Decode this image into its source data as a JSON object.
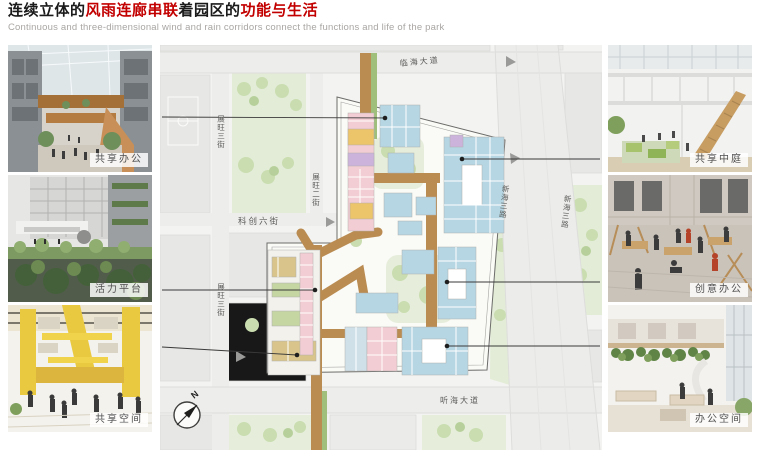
{
  "header": {
    "title_parts": [
      {
        "text": "连续立体的",
        "color": "#1a1a1a"
      },
      {
        "text": "风雨连廊串联",
        "color": "#c30000"
      },
      {
        "text": "着园区的",
        "color": "#1a1a1a"
      },
      {
        "text": "功能与生活",
        "color": "#c30000"
      }
    ],
    "subtitle": "Continuous and three-dimensional wind and rain corridors connect the functions and life of the park"
  },
  "left_photos": [
    {
      "label": "共享办公"
    },
    {
      "label": "活力平台"
    },
    {
      "label": "共享空间"
    }
  ],
  "right_photos": [
    {
      "label": "共享中庭"
    },
    {
      "label": "创意办公"
    },
    {
      "label": "办公空间"
    }
  ],
  "map": {
    "roads": {
      "top": "临海大道",
      "bottom": "听海大道",
      "mid": "科创六街",
      "left_outer": "展旺三街",
      "left_inner": "展旺二街",
      "right": "新海三路"
    },
    "north": "N",
    "colors": {
      "corridor": "#ba8c52",
      "corridor_green": "#9fbf7a",
      "block_blue": "#b5d6e2",
      "block_pink": "#f2cdd3",
      "block_yellow": "#ecc46a",
      "block_purple": "#cbb3dc",
      "block_green": "#c5d6a2",
      "block_tan": "#d9c58c",
      "park_green": "#e3ecd7",
      "accent_red": "#c30000"
    }
  }
}
